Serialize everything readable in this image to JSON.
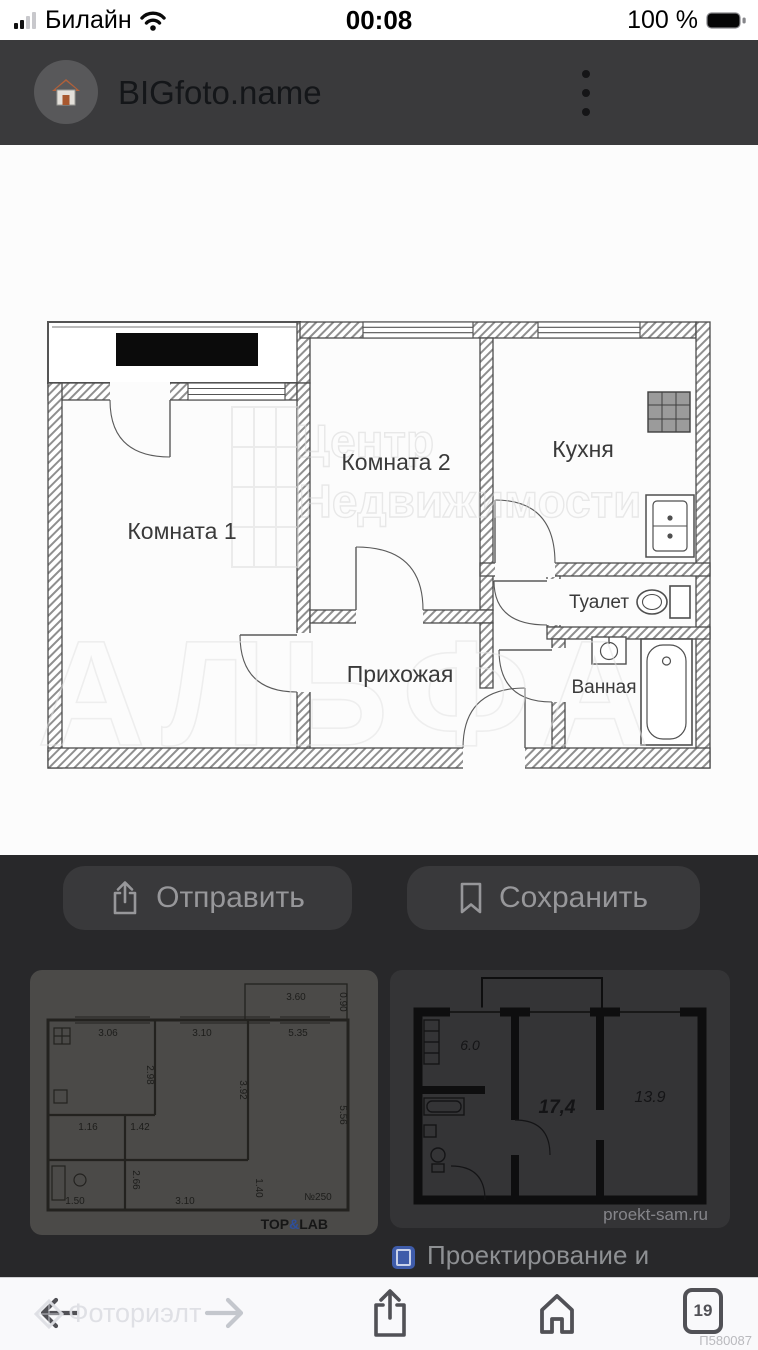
{
  "status_bar": {
    "carrier": "Билайн",
    "time": "00:08",
    "battery": "100 %"
  },
  "header": {
    "site": "BIGfoto.name"
  },
  "floorplan": {
    "room1": "Комната 1",
    "room2": "Комната 2",
    "kitchen": "Кухня",
    "toilet": "Туалет",
    "bathroom": "Ванная",
    "hallway": "Прихожая",
    "watermark_line1": "Центр",
    "watermark_line2": "Недвижимости",
    "watermark_line3": "АЛЬФА"
  },
  "actions": {
    "share": "Отправить",
    "save": "Сохранить"
  },
  "related": {
    "thumb1": {
      "top": [
        "3.06",
        "3.10",
        "5.35"
      ],
      "side": [
        "2.98",
        "3.92",
        "5.56"
      ],
      "balcony": [
        "3.60",
        "0.90"
      ],
      "inner": [
        "1.16",
        "1.42",
        "2.66"
      ],
      "bottom": [
        "1.50",
        "3.10",
        "1.40"
      ],
      "plan_no": "№250",
      "brand_top": "TOP",
      "brand_amp": "&",
      "brand_lab": "LAB"
    },
    "thumb2": {
      "kitchen_area": "6.0",
      "room1_area": "17,4",
      "room2_area": "13.9",
      "site": "proekt-sam.ru"
    },
    "caption": "Проектирование и"
  },
  "toolbar": {
    "tabs_count": "19",
    "photo_id": "П580087",
    "watermark": "Фоториэлт"
  },
  "colors": {
    "favicon_blue": "#3f5caa",
    "brand_amp_blue": "#2e4f9c",
    "header_bg": "#3a3a3c"
  }
}
